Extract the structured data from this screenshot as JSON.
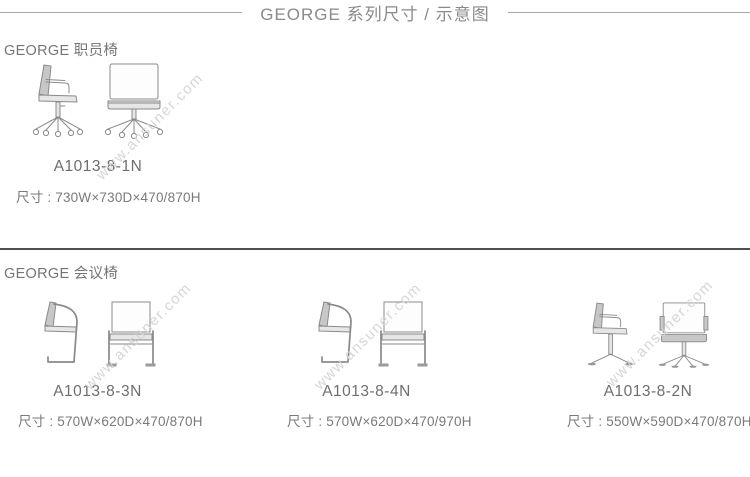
{
  "header": {
    "title": "GEORGE 系列尺寸 / 示意图"
  },
  "watermark": "www.ansuner.com",
  "colors": {
    "title_text": "#8a8a8a",
    "body_text": "#757575",
    "divider": "#4f4f4f",
    "title_rule": "#a6a6a6",
    "watermark_text": "#d6d6d6",
    "drawing_line": "#8a8a8a"
  },
  "sections": [
    {
      "heading": "GEORGE 职员椅",
      "items": [
        {
          "model": "A1013-8-1N",
          "dimensions": "尺寸 : 730W×730D×470/870H",
          "side_view_icon": "office-swivel-chair-side-view-casters",
          "front_view_icon": "office-swivel-chair-front-view-casters"
        }
      ]
    },
    {
      "heading": "GEORGE 会议椅",
      "items": [
        {
          "model": "A1013-8-3N",
          "dimensions": "尺寸 : 570W×620D×470/870H",
          "side_view_icon": "cantilever-chair-side-view",
          "front_view_icon": "cantilever-chair-front-view"
        },
        {
          "model": "A1013-8-4N",
          "dimensions": "尺寸 : 570W×620D×470/970H",
          "side_view_icon": "cantilever-chair-side-view",
          "front_view_icon": "cantilever-chair-front-view"
        },
        {
          "model": "A1013-8-2N",
          "dimensions": "尺寸 : 550W×590D×470/870H",
          "side_view_icon": "four-star-swivel-chair-side-view",
          "front_view_icon": "four-star-swivel-chair-front-view"
        }
      ]
    }
  ]
}
